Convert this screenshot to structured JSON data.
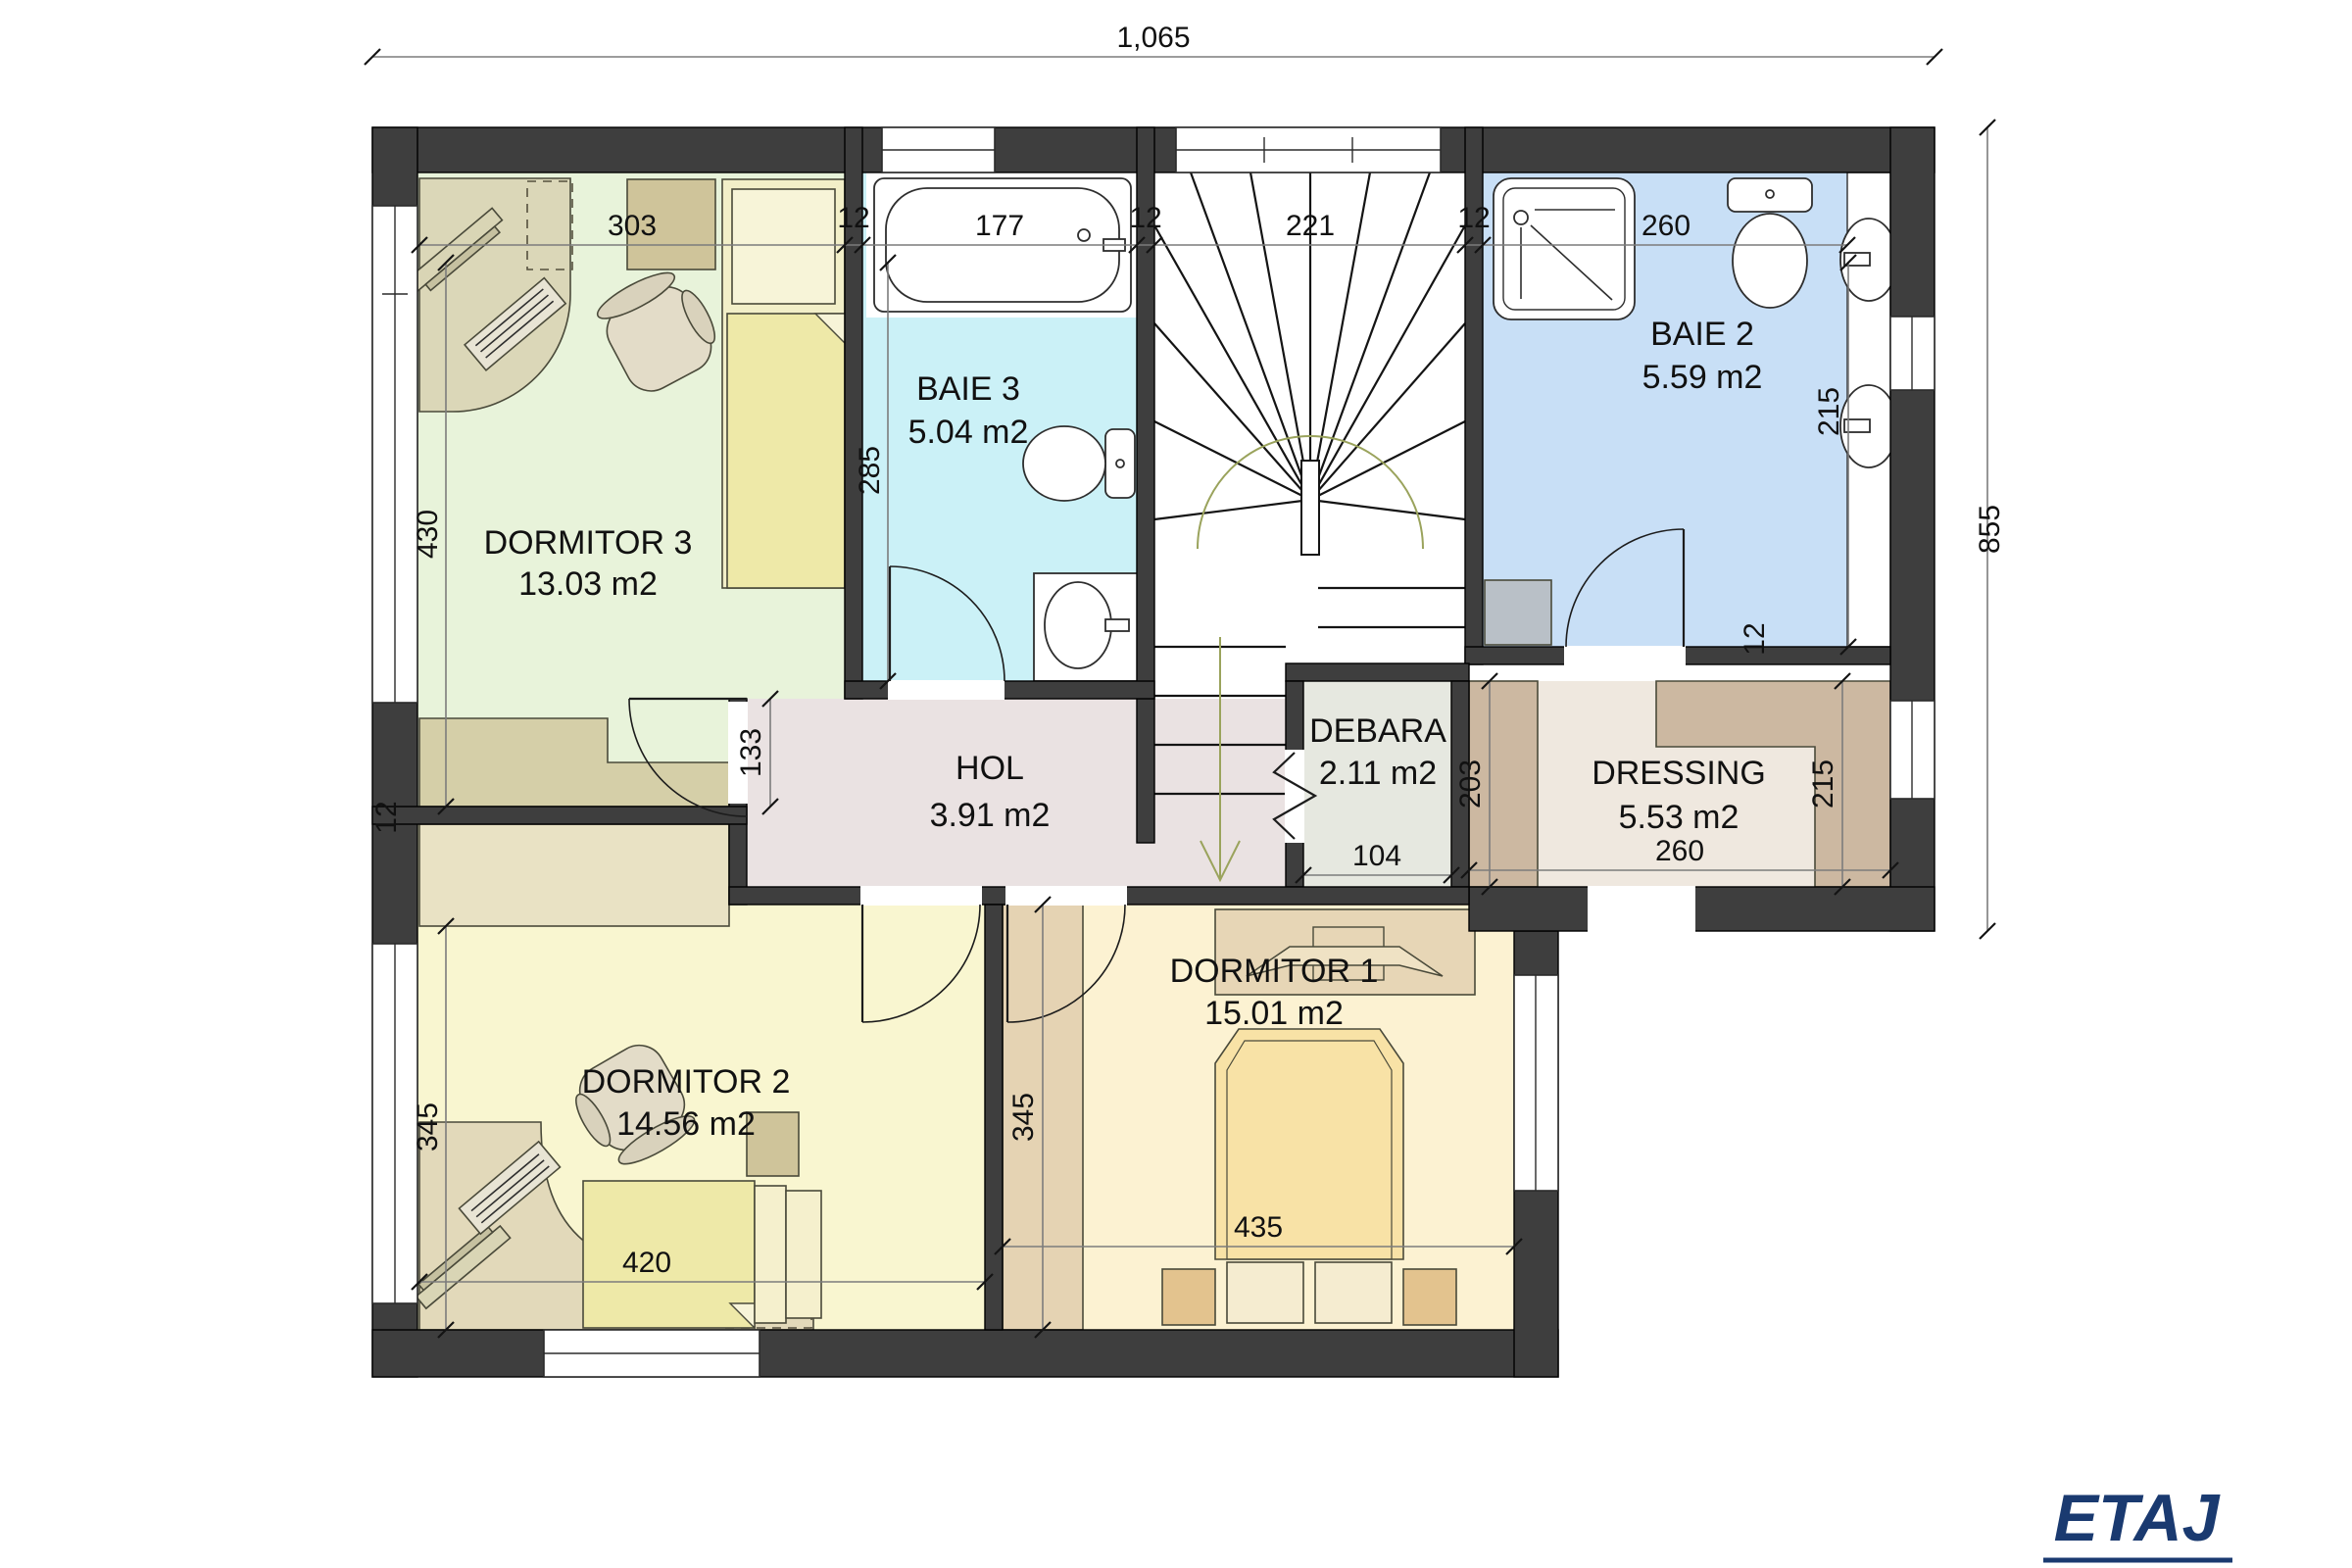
{
  "floor_label": "ETAJ",
  "accent_color": "#1a3a70",
  "dims": {
    "overall_width": "1,065",
    "overall_height": "855",
    "wall": "12",
    "dormitor3_width": "303",
    "dormitor3_height": "430",
    "baie3_width": "177",
    "baie3_height": "285",
    "stairs_width": "221",
    "baie2_width": "260",
    "baie2_vanity": "215",
    "hol_height": "133",
    "debara_width": "104",
    "dressing_left": "203",
    "dressing_right": "215",
    "dressing_width": "260",
    "dormitor2_height": "345",
    "dormitor2_width": "420",
    "dormitor1_height": "345",
    "dormitor1_width": "435"
  },
  "rooms": [
    {
      "name": "DORMITOR 3",
      "area": "13.03 m2"
    },
    {
      "name": "BAIE 3",
      "area": "5.04 m2"
    },
    {
      "name": "BAIE 2",
      "area": "5.59 m2"
    },
    {
      "name": "HOL",
      "area": "3.91 m2"
    },
    {
      "name": "DEBARA",
      "area": "2.11 m2"
    },
    {
      "name": "DRESSING",
      "area": "5.53 m2"
    },
    {
      "name": "DORMITOR 2",
      "area": "14.56 m2"
    },
    {
      "name": "DORMITOR 1",
      "area": "15.01 m2"
    }
  ]
}
